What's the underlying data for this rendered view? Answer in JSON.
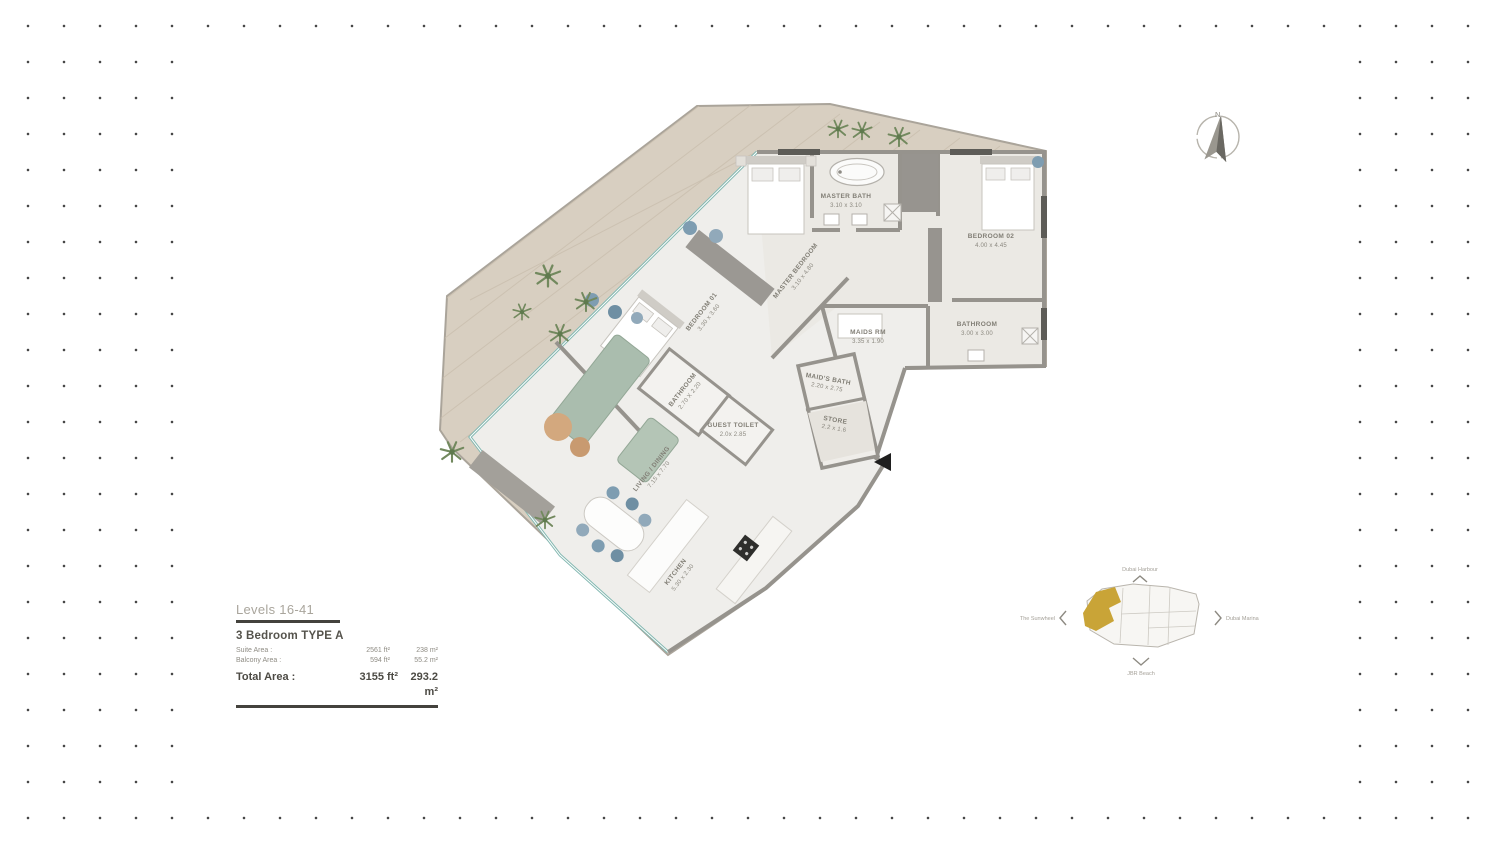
{
  "info_panel": {
    "levels": "Levels 16-41",
    "unit_type": "3 Bedroom  TYPE A",
    "rows": [
      {
        "label": "Suite Area :",
        "ft": "2561 ft²",
        "m": "238 m²"
      },
      {
        "label": "Balcony Area :",
        "ft": "594 ft²",
        "m": "55.2 m²"
      }
    ],
    "total": {
      "label": "Total Area :",
      "ft": "3155 ft²",
      "m": "293.2 m²"
    }
  },
  "compass": {
    "north_label": "N"
  },
  "rooms": [
    {
      "name": "MASTER BATH",
      "dims": "3.10 x 3.10"
    },
    {
      "name": "BEDROOM 02",
      "dims": "4.00 x 4.45"
    },
    {
      "name": "MASTER BEDROOM",
      "dims": "3.10 x 4.80"
    },
    {
      "name": "BEDROOM 01",
      "dims": "3.30 x 3.60"
    },
    {
      "name": "MAIDS RM",
      "dims": "3.35 x 1.90"
    },
    {
      "name": "BATHROOM",
      "dims": "3.00 x 3.00"
    },
    {
      "name": "MAID'S BATH",
      "dims": "2.20 x 2.75"
    },
    {
      "name": "STORE",
      "dims": "2.2 x 1.6"
    },
    {
      "name": "GUEST TOILET",
      "dims": "2.0x 2.85"
    },
    {
      "name": "BATHROOM",
      "dims": "2.70 X 2.20"
    },
    {
      "name": "LIVING / DINING",
      "dims": "7.15 x 7.70"
    },
    {
      "name": "KITCHEN",
      "dims": "5.30 x 2.30"
    }
  ],
  "key_plan": {
    "labels": {
      "top": "Dubai Harbour",
      "left": "The Sunwheel",
      "right": "Dubai Marina",
      "bottom": "JBR Beach"
    },
    "highlight_color": "#c9a437"
  },
  "colors": {
    "deck_wood": "#d8cfc1",
    "floor": "#efeeeb",
    "wall": "#96938d",
    "glass": "#83b8b1",
    "entry_marker": "#1f1f1f"
  }
}
